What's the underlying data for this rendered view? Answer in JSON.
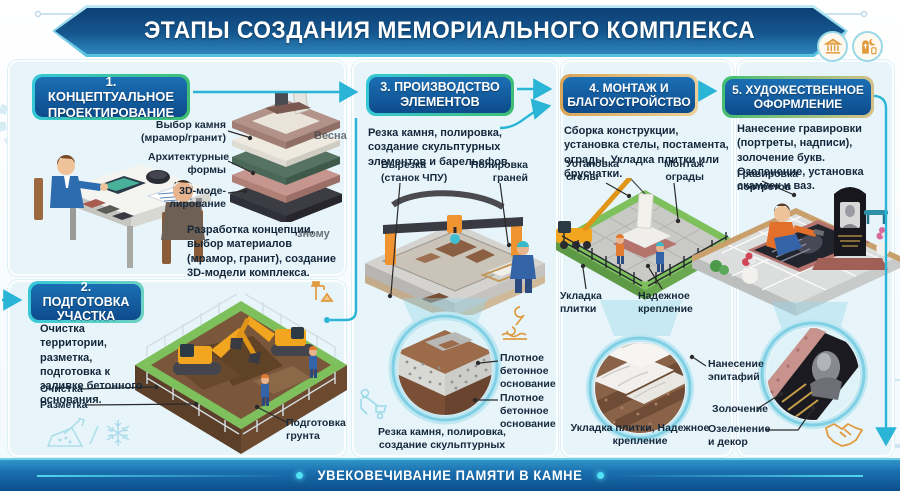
{
  "header": {
    "title": "ЭТАПЫ СОЗДАНИЯ МЕМОРИАЛЬНОГО КОМПЛЕКСА"
  },
  "footer": {
    "title": "УВЕКОВЕЧИВАНИЕ ПАМЯТИ В КАМНЕ"
  },
  "watermarks": {
    "w1": "Весна",
    "w2": "зному"
  },
  "top_icons": [
    {
      "name": "classical-building-icon"
    },
    {
      "name": "headstone-religions-icon"
    }
  ],
  "colors": {
    "header_blue": "#15578f",
    "accent_cyan": "#35c8d8",
    "accent_green": "#3fbe72",
    "panel_bg": "#e7f5fb",
    "footer_blue": "#0c4e8b",
    "orange_icon": "#e0983a"
  },
  "sections": [
    {
      "badge": "1. КОНЦЕПТУАЛЬНОЕ ПРОЕКТИРОВАНИЕ",
      "labels": [
        "Выбор камня (мрамор/гранит)",
        "Архитектурные формы",
        "3D-моде-лирование"
      ],
      "description": "Разработка концепции, выбор материалов (мрамор, гранит), создание 3D-модели комплекса."
    },
    {
      "badge": "2. ПОДГОТОВКА УЧАСТКА",
      "description": "Очистка территории, разметка, подготовка к заливке бетонного основания.",
      "labels": [
        "Очистка",
        "Разметка",
        "Подготовка грунта"
      ]
    },
    {
      "badge": "3. ПРОИЗВОДСТВО ЭЛЕМЕНТОВ",
      "description": "Резка камня, полировка, создание скульптурных элементов и барельефов.",
      "labels": [
        "Вырезка (станок ЧПУ)",
        "Полировка граней"
      ],
      "zoom_labels": [
        "Плотное бетонное основание",
        "Плотное бетонное основание"
      ],
      "caption": "Резка камня, полировка, создание скульптурных"
    },
    {
      "badge": "4. МОНТАЖ И БЛАГОУСТРОЙСТВО",
      "description": "Сборка конструкции, установка стелы, постамента, ограды. Укладка плитки или брусчатки.",
      "labels": [
        "Установка стелы",
        "Монтаж ограды",
        "Укладка плитки",
        "Надежное крепление"
      ],
      "caption": "Укладка плитки, Надежное крепление"
    },
    {
      "badge": "5. ХУДОЖЕСТВЕННОЕ ОФОРМЛЕНИЕ",
      "description": "Нанесение гравировки (портреты, надписи), золочение букв. Озеленение, установка скамеек и ваз.",
      "labels": [
        "Гравировка портретов",
        "Нанесение эпитафий",
        "Золочение",
        "Озеленение и декор"
      ]
    }
  ]
}
